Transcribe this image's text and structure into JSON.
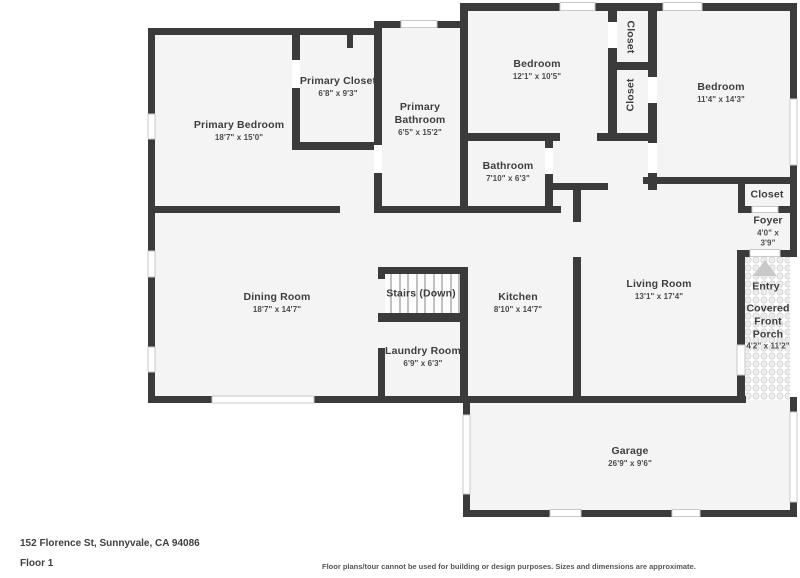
{
  "meta": {
    "address": "152 Florence St, Sunnyvale, CA 94086",
    "floor_label": "Floor 1",
    "disclaimer": "Floor plans/tour cannot be used for building or design purposes. Sizes and dimensions are approximate."
  },
  "colors": {
    "wall": "#3b3b3b",
    "room_fill": "#f4f4f4",
    "label_text": "#3e3e3e",
    "window_stroke": "#c9c9c9",
    "porch_tile": "#ececec",
    "entry_arrow": "#c9c9c9"
  },
  "rooms": {
    "primary_bedroom": {
      "name": "Primary Bedroom",
      "dims": "18'7\" x 15'0\""
    },
    "primary_closet": {
      "name": "Primary Closet",
      "dims": "6'8\" x 9'3\""
    },
    "primary_bathroom": {
      "name": "Primary Bathroom",
      "dims": "6'5\" x 15'2\""
    },
    "bedroom_left": {
      "name": "Bedroom",
      "dims": "12'1\" x 10'5\""
    },
    "bedroom_right": {
      "name": "Bedroom",
      "dims": "11'4\" x 14'3\""
    },
    "bathroom": {
      "name": "Bathroom",
      "dims": "7'10\" x 6'3\""
    },
    "closet_top": {
      "name": "Closet"
    },
    "closet_mid": {
      "name": "Closet"
    },
    "closet_foyer": {
      "name": "Closet"
    },
    "foyer": {
      "name": "Foyer",
      "dims": "4'0\" x 3'9\""
    },
    "entry": {
      "name": "Entry"
    },
    "porch": {
      "name": "Covered Front Porch",
      "dims": "4'2\" x 11'2\""
    },
    "dining": {
      "name": "Dining Room",
      "dims": "18'7\" x 14'7\""
    },
    "stairs": {
      "name": "Stairs (Down)"
    },
    "kitchen": {
      "name": "Kitchen",
      "dims": "8'10\" x 14'7\""
    },
    "living": {
      "name": "Living Room",
      "dims": "13'1\" x 17'4\""
    },
    "laundry": {
      "name": "Laundry Room",
      "dims": "6'9\" x 6'3\""
    },
    "garage": {
      "name": "Garage",
      "dims": "26'9\" x 9'6\""
    }
  }
}
